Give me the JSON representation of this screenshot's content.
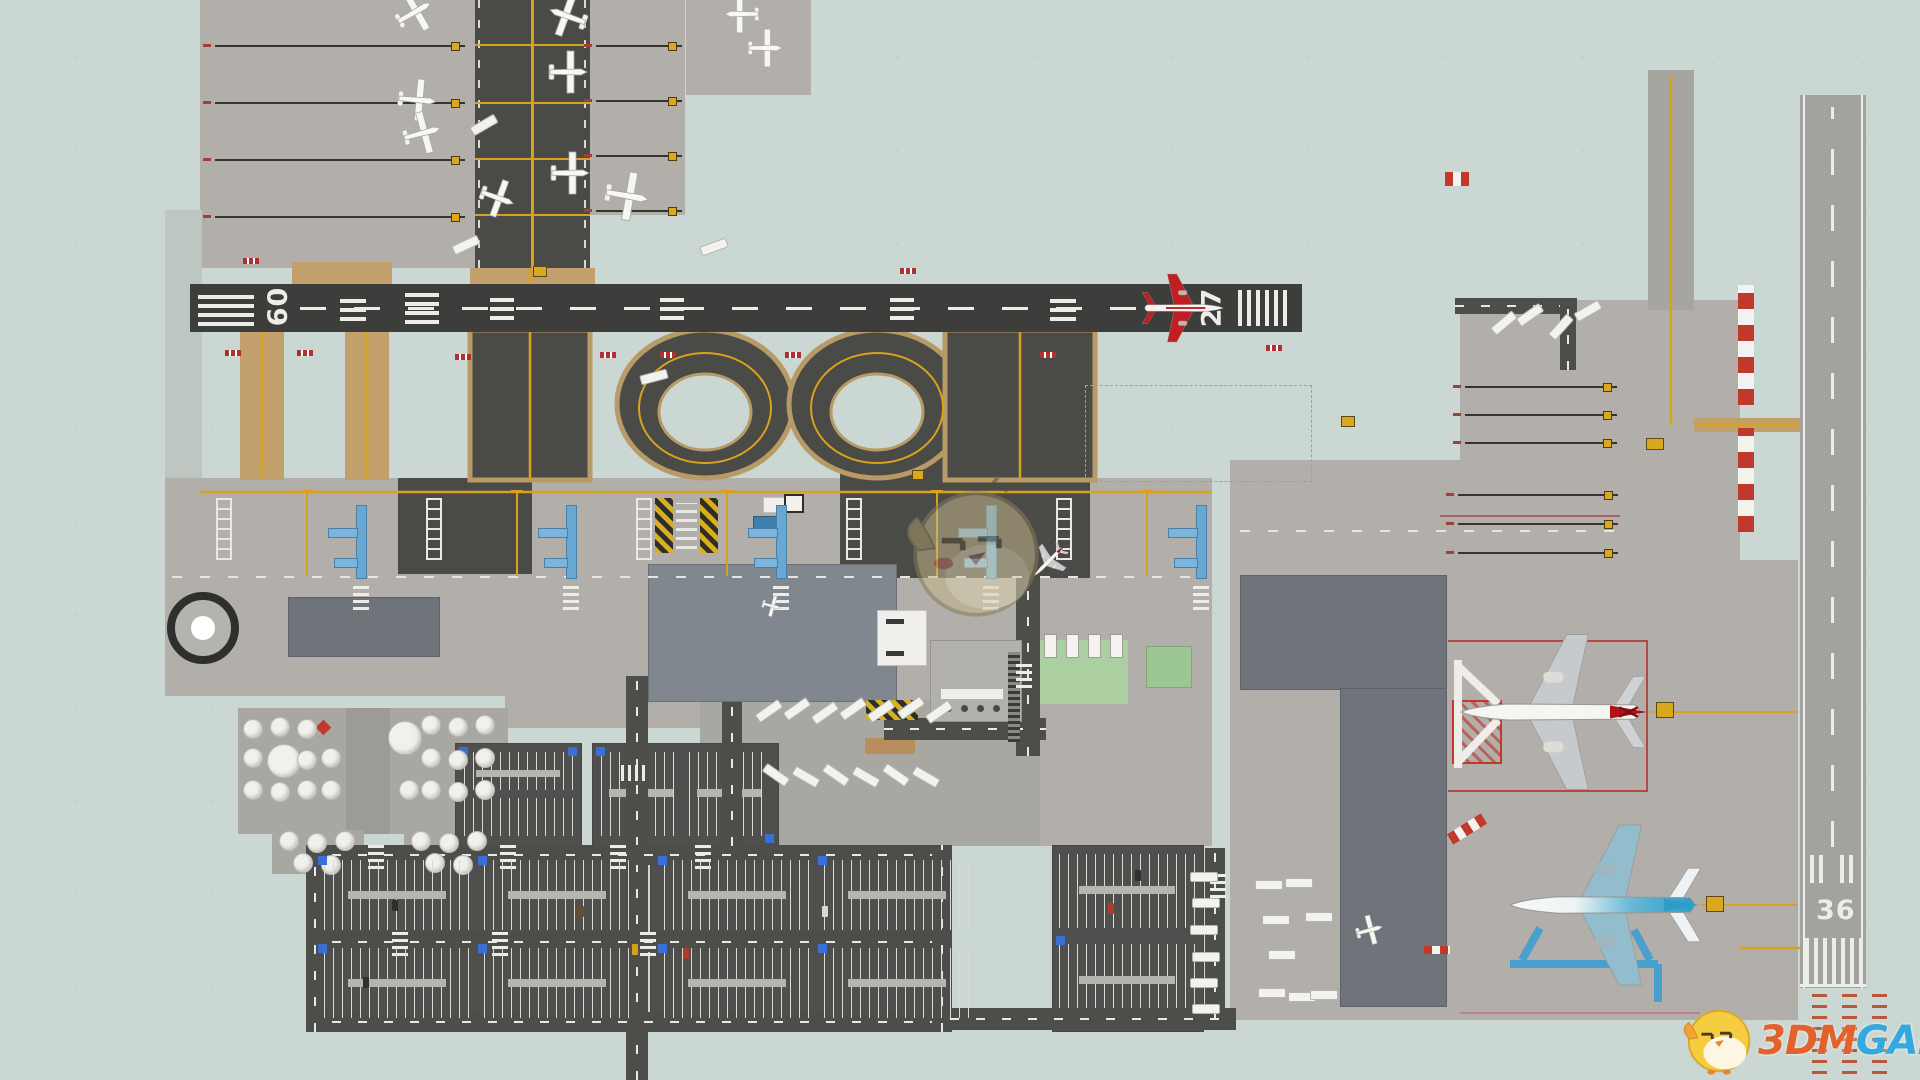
{
  "app": {
    "type": "airport-builder-game",
    "view": "top-down airport map",
    "resolution": "1920x1080"
  },
  "colors": {
    "grass": "#cbd7d3",
    "apron": "#b2afaa",
    "apron_dark": "#a9a7a2",
    "asphalt": "#4a4a47",
    "runway_asphalt": "#3d3d3b",
    "runway_concrete": "#a3a29e",
    "road": "#4d4d4a",
    "taxi_shoulder": "#c2a06c",
    "taxi_line": "#d8a21c",
    "jet_bridge": "#69a8d2",
    "security_green": "#abcfa0",
    "hazard_yellow": "#d8b01c",
    "marker_red": "#b03030",
    "checker_red": "#c0392b",
    "watermark_orange": "#e2622b",
    "watermark_blue": "#35a9de"
  },
  "runways": {
    "h": {
      "left": "09",
      "right": "27",
      "surface": "asphalt",
      "orientation": "east-west"
    },
    "v": {
      "num": "36",
      "surface": "concrete",
      "orientation": "north-south"
    }
  },
  "watermark": {
    "part1": "3DM",
    "part2": "GAME",
    "mascot": "3dm-chick-logo"
  },
  "mascot_overlay": {
    "name": "3dm-chick-faint",
    "opacity": 0.55
  },
  "aircraft": [
    {
      "name": "airliner-on-runway-27",
      "livery": "white-red",
      "x": 1185,
      "y": 308,
      "rot": 0,
      "s": 0.68
    },
    {
      "name": "airliner-red-tail-at-gate",
      "livery": "red-tail",
      "x": 1548,
      "y": 712,
      "rot": 180,
      "s": 1.55
    },
    {
      "name": "airliner-blue-at-gate",
      "livery": "blue",
      "x": 1600,
      "y": 905,
      "rot": 180,
      "s": 1.6
    },
    {
      "name": "jet-taxiing",
      "livery": "red-tail",
      "x": 1048,
      "y": 562,
      "rot": 135,
      "s": 0.34
    }
  ],
  "ga_planes": [
    [
      415,
      12,
      -30,
      1
    ],
    [
      567,
      16,
      200,
      1
    ],
    [
      569,
      72,
      0,
      1
    ],
    [
      418,
      100,
      5,
      1
    ],
    [
      423,
      133,
      -15,
      1
    ],
    [
      571,
      173,
      0,
      1
    ],
    [
      628,
      196,
      10,
      1.15
    ],
    [
      741,
      14,
      180,
      0.9
    ],
    [
      766,
      48,
      0,
      0.9
    ],
    [
      498,
      198,
      20,
      0.9
    ],
    [
      1370,
      930,
      -15,
      0.7
    ],
    [
      772,
      606,
      15,
      0.5
    ]
  ],
  "scene": {
    "roads": [
      [
        626,
        676,
        22,
        404
      ],
      [
        306,
        845,
        646,
        20
      ],
      [
        306,
        932,
        646,
        20
      ],
      [
        306,
        1012,
        646,
        20
      ],
      [
        306,
        845,
        18,
        187
      ],
      [
        932,
        845,
        20,
        187
      ],
      [
        950,
        1008,
        286,
        22
      ],
      [
        1205,
        848,
        20,
        170
      ],
      [
        1016,
        578,
        24,
        178
      ],
      [
        884,
        718,
        162,
        22
      ],
      [
        722,
        688,
        20,
        158
      ],
      [
        1455,
        298,
        122,
        16
      ],
      [
        1560,
        298,
        16,
        72
      ]
    ],
    "zebras": [
      [
        368,
        843,
        0
      ],
      [
        500,
        843,
        0
      ],
      [
        610,
        843,
        0
      ],
      [
        695,
        843,
        0
      ],
      [
        392,
        930,
        0
      ],
      [
        492,
        930,
        0
      ],
      [
        640,
        930,
        0
      ],
      [
        626,
        760,
        90
      ],
      [
        1016,
        662,
        0
      ],
      [
        1210,
        872,
        0
      ]
    ],
    "stand_units": [
      210,
      420,
      630,
      840,
      1050
    ],
    "stand_rows": [
      [
        215,
        45,
        250,
        4,
        57
      ],
      [
        596,
        45,
        86,
        4,
        55
      ],
      [
        1465,
        386,
        152,
        3,
        28
      ],
      [
        1458,
        494,
        160,
        3,
        29
      ]
    ],
    "tanks_big": [
      [
        283,
        760
      ],
      [
        404,
        737
      ]
    ],
    "tanks_small": [
      [
        252,
        728
      ],
      [
        279,
        726
      ],
      [
        306,
        728
      ],
      [
        252,
        757
      ],
      [
        306,
        759
      ],
      [
        252,
        789
      ],
      [
        279,
        791
      ],
      [
        306,
        789
      ],
      [
        330,
        757
      ],
      [
        330,
        789
      ],
      [
        430,
        724
      ],
      [
        457,
        726
      ],
      [
        484,
        724
      ],
      [
        430,
        757
      ],
      [
        457,
        759
      ],
      [
        484,
        757
      ],
      [
        430,
        789
      ],
      [
        457,
        791
      ],
      [
        484,
        789
      ],
      [
        408,
        789
      ],
      [
        288,
        840
      ],
      [
        316,
        842
      ],
      [
        344,
        840
      ],
      [
        420,
        840
      ],
      [
        448,
        842
      ],
      [
        476,
        840
      ],
      [
        302,
        862
      ],
      [
        330,
        864
      ],
      [
        434,
        862
      ],
      [
        462,
        864
      ]
    ],
    "vehicles": [
      [
        755,
        706,
        -35
      ],
      [
        783,
        704,
        -35
      ],
      [
        811,
        708,
        -35
      ],
      [
        839,
        704,
        -35
      ],
      [
        867,
        706,
        -35
      ],
      [
        897,
        703,
        -35
      ],
      [
        925,
        707,
        -35
      ],
      [
        762,
        770,
        35
      ],
      [
        792,
        772,
        30
      ],
      [
        822,
        770,
        35
      ],
      [
        852,
        772,
        30
      ],
      [
        882,
        770,
        35
      ],
      [
        912,
        772,
        30
      ],
      [
        1190,
        872,
        0
      ],
      [
        1192,
        898,
        0
      ],
      [
        1190,
        925,
        0
      ],
      [
        1192,
        952,
        0
      ],
      [
        1190,
        978,
        0
      ],
      [
        1192,
        1004,
        0
      ],
      [
        1255,
        880,
        0
      ],
      [
        1285,
        878,
        0
      ],
      [
        1262,
        915,
        0
      ],
      [
        1305,
        912,
        0
      ],
      [
        1268,
        950,
        0
      ],
      [
        1258,
        988,
        0
      ],
      [
        1288,
        992,
        0
      ],
      [
        1310,
        990,
        0
      ],
      [
        1490,
        318,
        -40
      ],
      [
        1516,
        310,
        -35
      ],
      [
        1547,
        322,
        -48
      ],
      [
        1574,
        306,
        -30
      ],
      [
        452,
        240,
        -25
      ],
      [
        700,
        242,
        -20
      ],
      [
        470,
        120,
        -30
      ],
      [
        640,
        372,
        -15
      ]
    ],
    "cars": [
      [
        392,
        900,
        "#2f2f2d"
      ],
      [
        578,
        906,
        "#6b4a2e"
      ],
      [
        822,
        906,
        "#d8d8d3"
      ],
      [
        363,
        977,
        "#2f2f2d"
      ],
      [
        683,
        948,
        "#b03a2e"
      ],
      [
        632,
        944,
        "#d4a017"
      ],
      [
        1108,
        903,
        "#b03a2e"
      ],
      [
        1135,
        870,
        "#2f2f2d"
      ]
    ],
    "red_markers": [
      [
        225,
        350
      ],
      [
        297,
        350
      ],
      [
        455,
        354
      ],
      [
        600,
        352
      ],
      [
        660,
        352
      ],
      [
        785,
        352
      ],
      [
        1040,
        352
      ],
      [
        243,
        258
      ],
      [
        1266,
        345
      ],
      [
        900,
        268
      ]
    ],
    "signs": [
      [
        1656,
        702,
        16,
        14
      ],
      [
        1706,
        896,
        16,
        14
      ],
      [
        1646,
        438,
        16,
        10
      ],
      [
        533,
        266,
        12,
        9
      ],
      [
        1341,
        416,
        12,
        9
      ],
      [
        912,
        470,
        10,
        8
      ]
    ],
    "orange_cols": [
      [
        1812,
        988
      ],
      [
        1842,
        988
      ],
      [
        1872,
        988
      ]
    ]
  }
}
